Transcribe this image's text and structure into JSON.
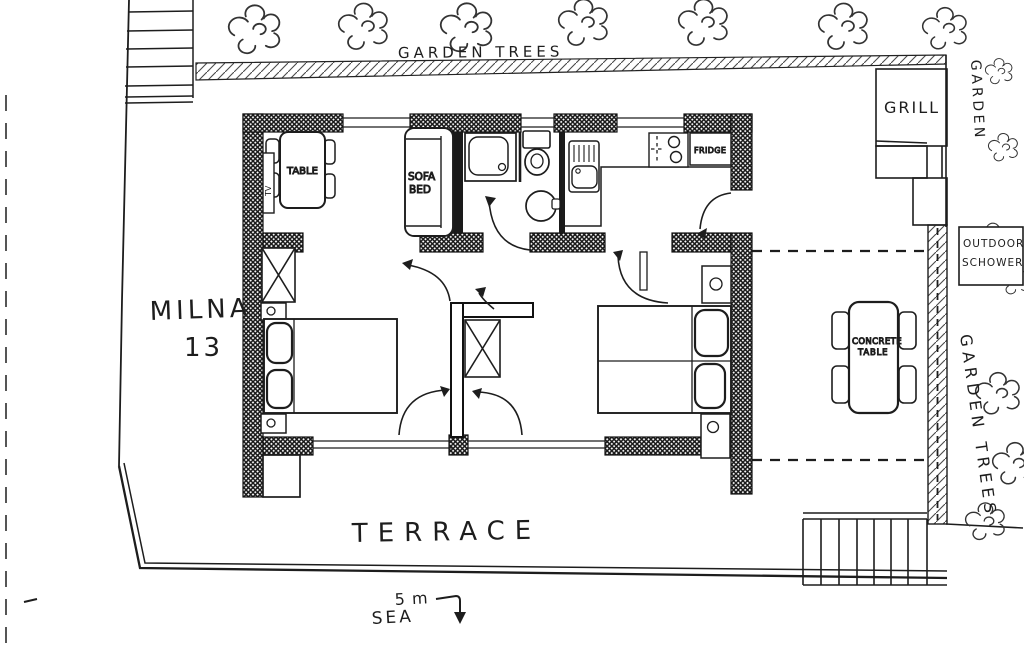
{
  "colors": {
    "ink": "#1d1d1d",
    "paper": "#ffffff"
  },
  "labels": {
    "garden_trees_top": "GARDEN TREES",
    "garden_right": "GARDEN",
    "garden_trees_right": "GARDEN TREES",
    "grill": "GRILL",
    "outdoor_shower_line1": "OUTDOOR",
    "outdoor_shower_line2": "SCHOWER",
    "concrete_table_line1": "CONCRETE",
    "concrete_table_line2": "TABLE",
    "house_name_line1": "MILNA",
    "house_name_line2": "13",
    "terrace": "TERRACE",
    "scale_distance": "5 m",
    "sea": "SEA",
    "dining_table": "TABLE",
    "sofa_bed_line1": "SOFA",
    "sofa_bed_line2": "BED",
    "fridge": "FRIDGE",
    "tv": "TV"
  }
}
